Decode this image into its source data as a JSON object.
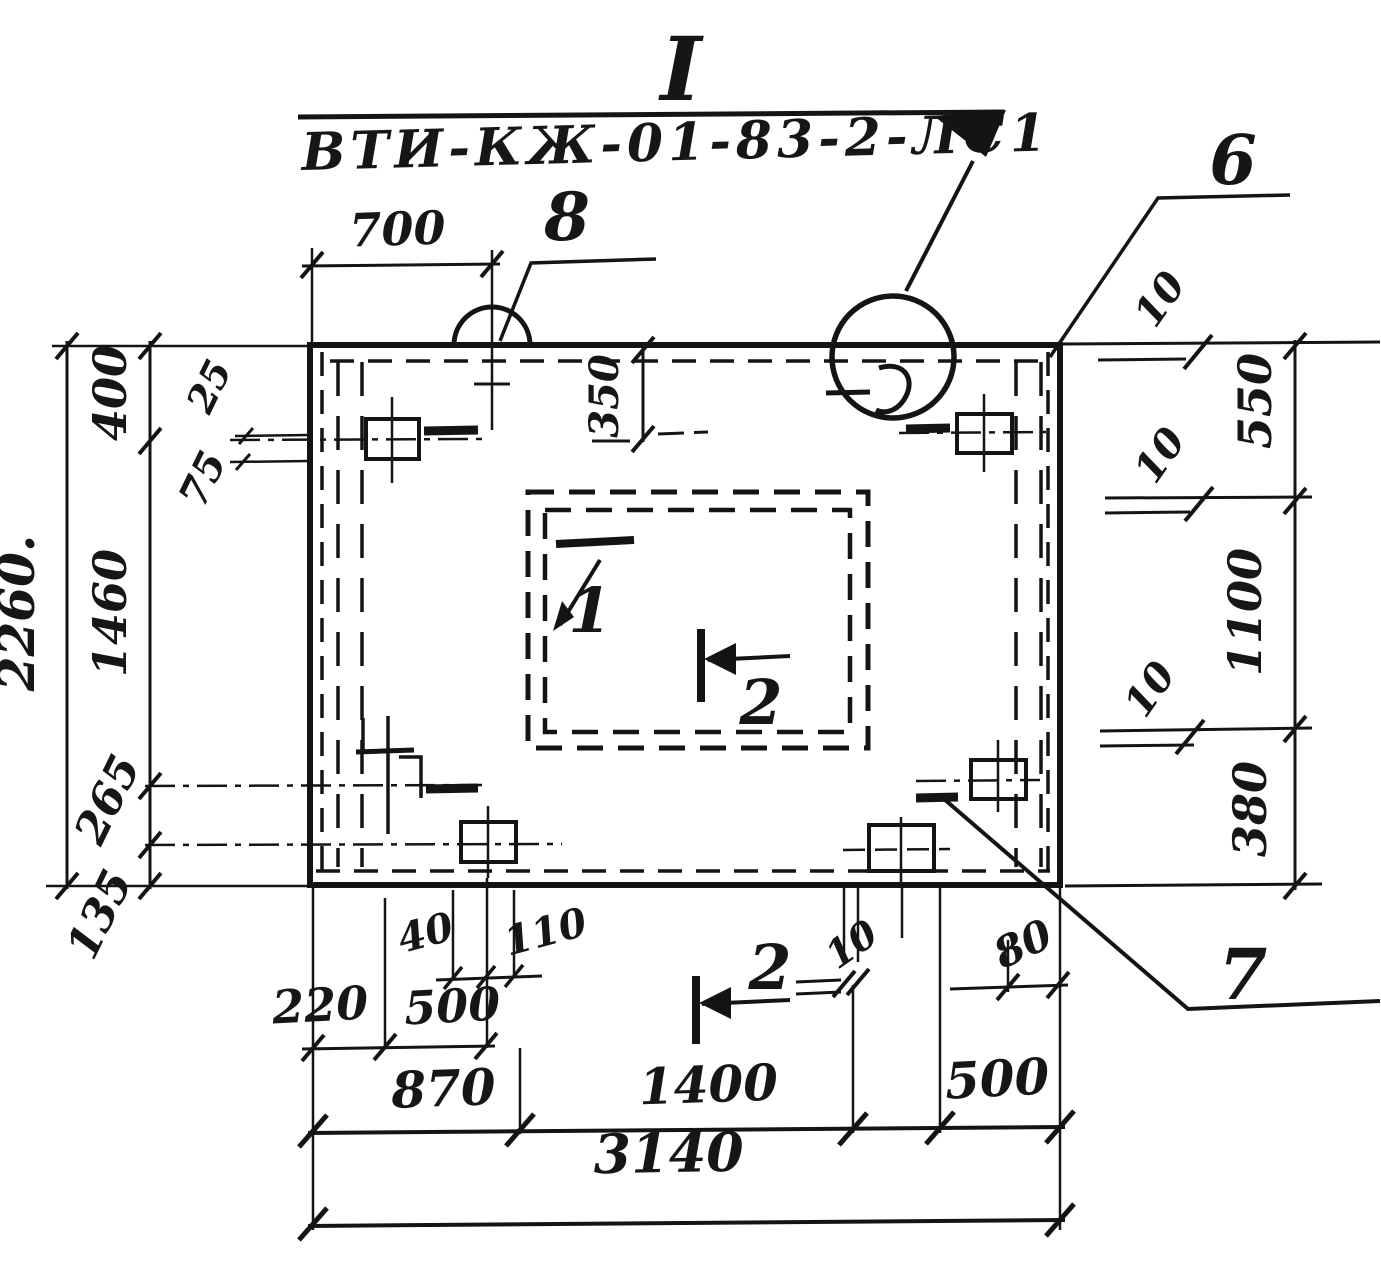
{
  "drawing": {
    "title_mark": "I",
    "designation": "ВТИ-КЖ-01-83-2-ЛС1",
    "callouts": {
      "notch": "8",
      "top_right": "6",
      "bottom_right": "7"
    },
    "sections": {
      "one": "1",
      "two_plan": "2",
      "two_elev": "2"
    },
    "dims": {
      "top": {
        "d700": "700",
        "d350": "350"
      },
      "left": {
        "overall": "2260.",
        "d400": "400",
        "d1460": "1460",
        "d265": "265",
        "d135": "135",
        "d25": "25",
        "d75": "75"
      },
      "right": {
        "d550": "550",
        "d1100": "1100",
        "d380": "380",
        "d10_1": "10",
        "d10_2": "10",
        "d10_3": "10"
      },
      "bottom": {
        "d40": "40",
        "d110": "110",
        "d220": "220",
        "d500a": "500",
        "d10": "10",
        "d80": "80",
        "d870": "870",
        "d1400": "1400",
        "d500b": "500",
        "overall": "3140"
      }
    }
  }
}
